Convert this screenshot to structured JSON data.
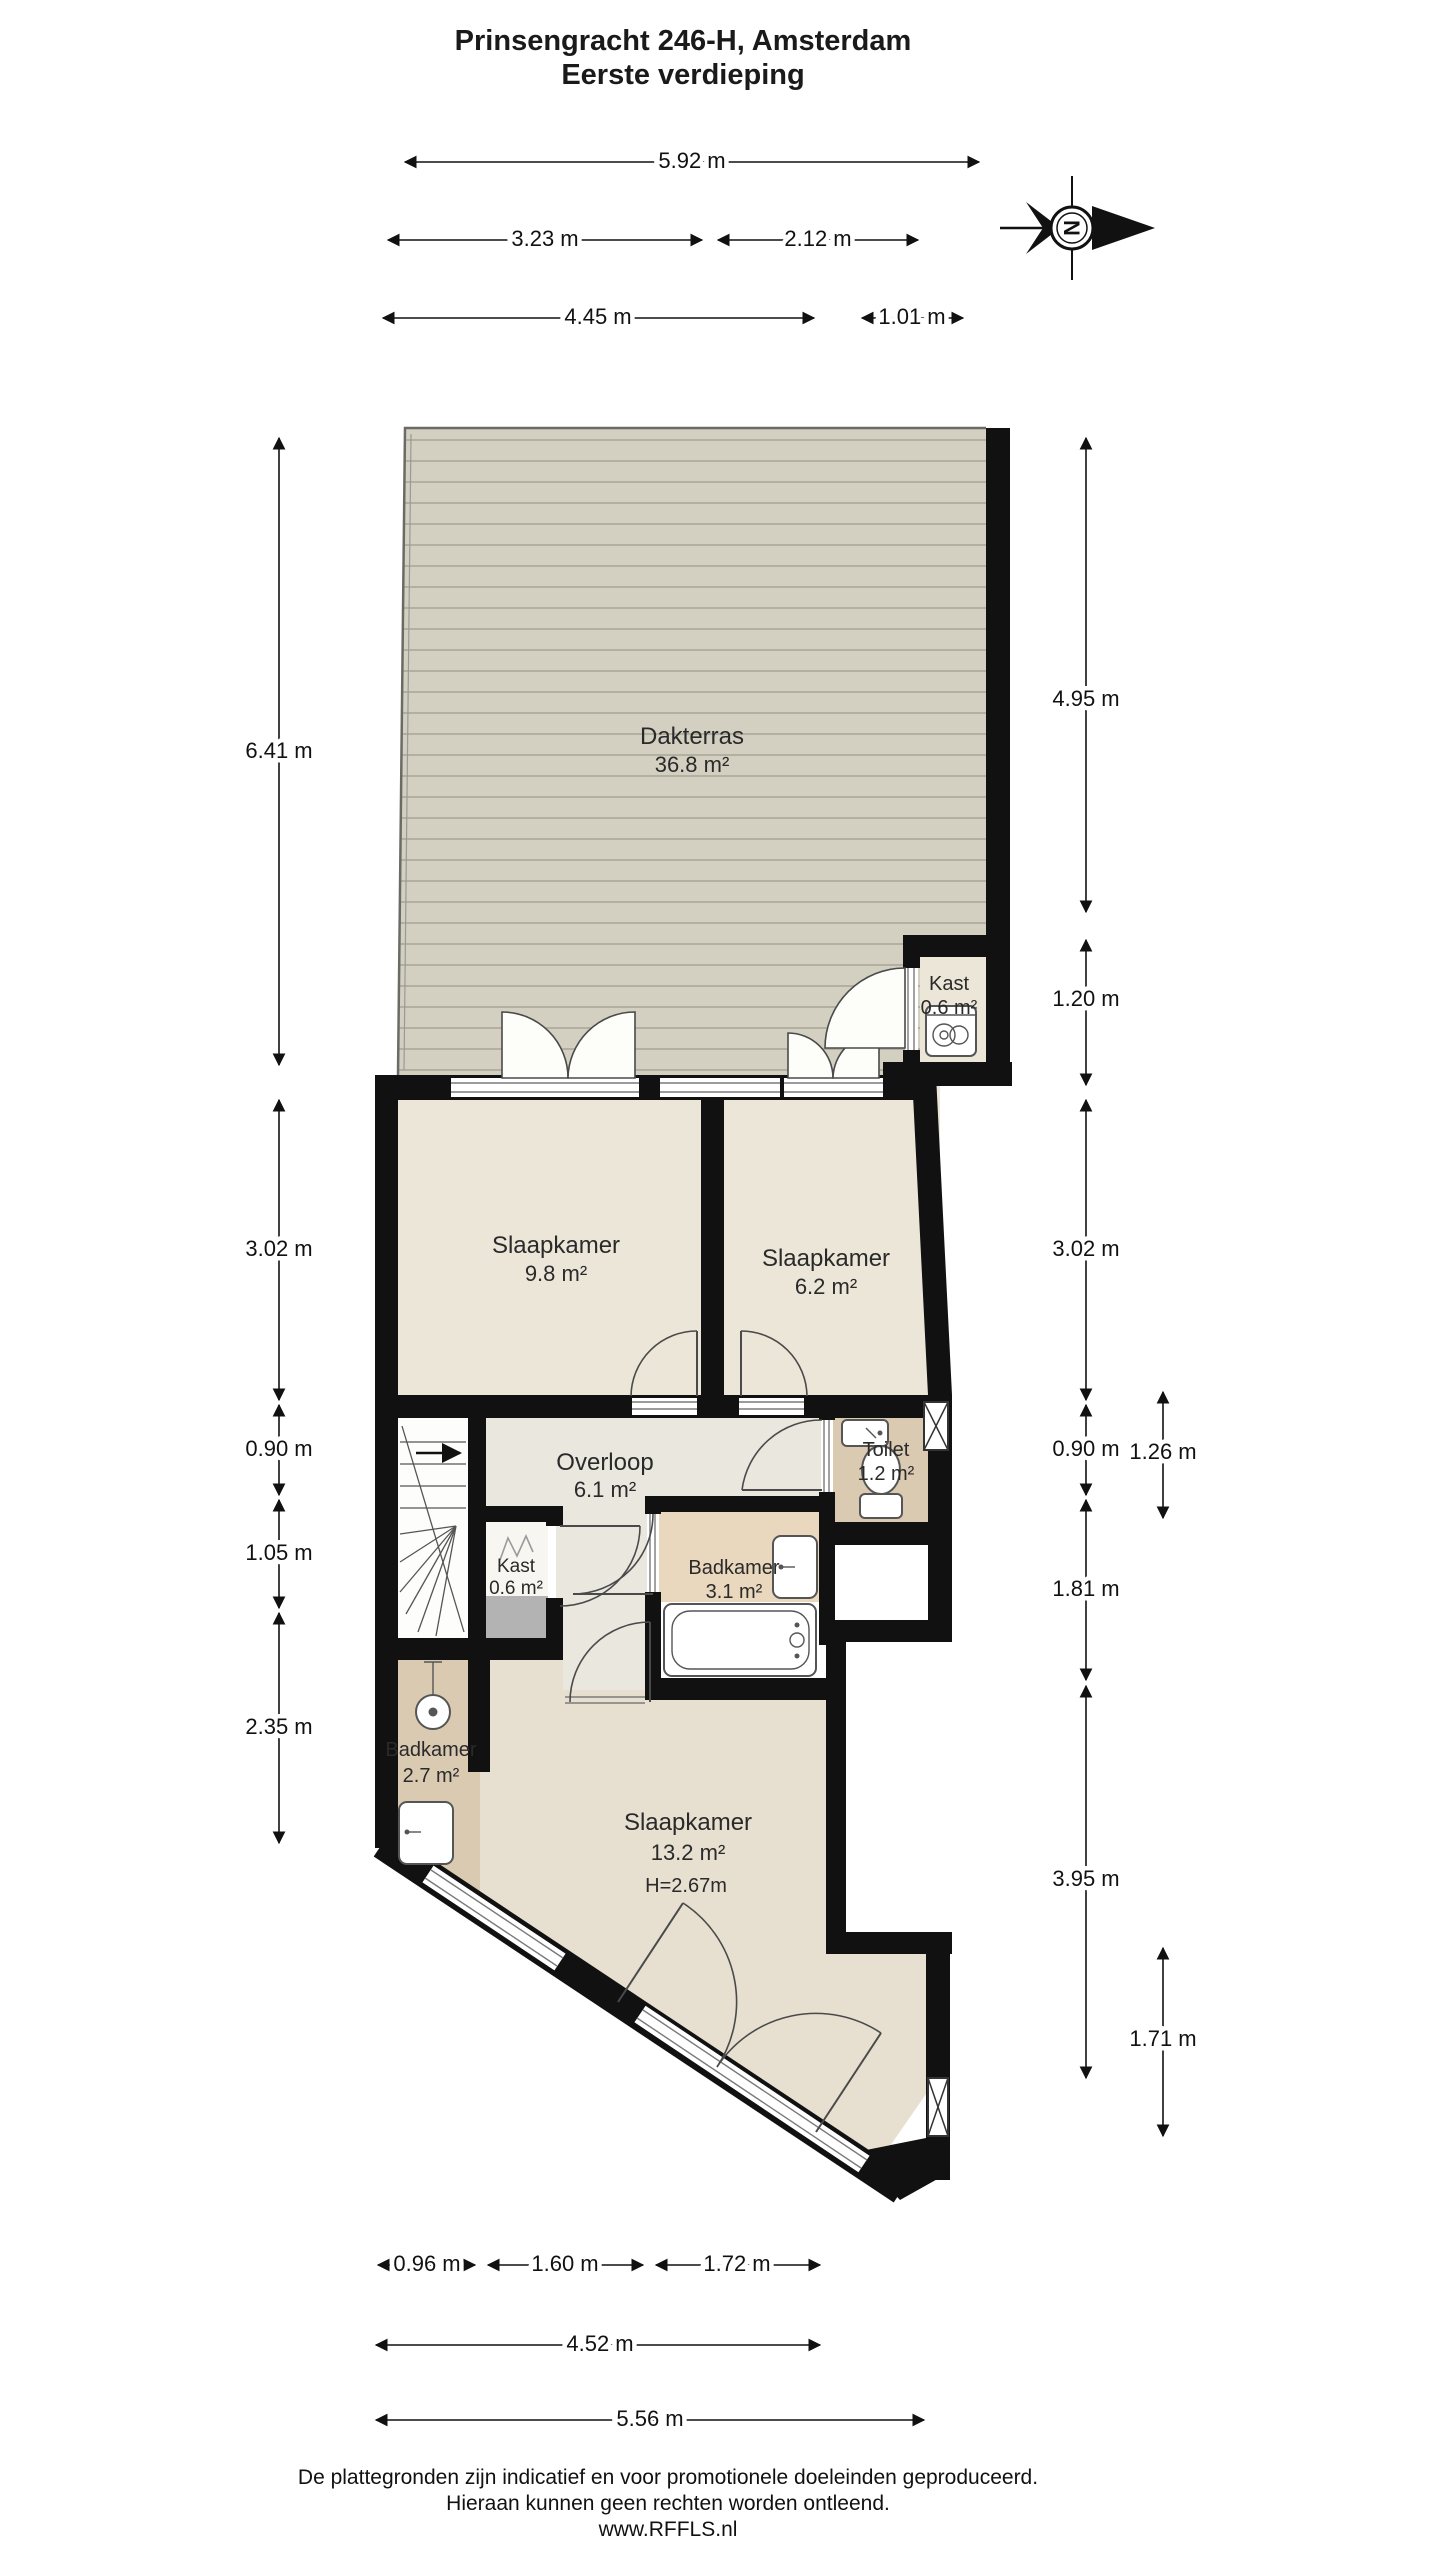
{
  "title": {
    "line1": "Prinsengracht 246-H, Amsterdam",
    "line2": "Eerste verdieping"
  },
  "compass": {
    "letter": "N"
  },
  "rooms": {
    "dakterras": {
      "name": "Dakterras",
      "area": "36.8 m²"
    },
    "kast_boven": {
      "name": "Kast",
      "area": "0.6 m²"
    },
    "slaapkamer_1": {
      "name": "Slaapkamer",
      "area": "9.8 m²"
    },
    "slaapkamer_2": {
      "name": "Slaapkamer",
      "area": "6.2 m²"
    },
    "overloop": {
      "name": "Overloop",
      "area": "6.1 m²"
    },
    "toilet": {
      "name": "Toilet",
      "area": "1.2 m²"
    },
    "kast_midden": {
      "name": "Kast",
      "area": "0.6 m²"
    },
    "badkamer_1": {
      "name": "Badkamer",
      "area": "3.1 m²"
    },
    "badkamer_2": {
      "name": "Badkamer",
      "area": "2.7 m²"
    },
    "slaapkamer_3": {
      "name": "Slaapkamer",
      "area": "13.2 m²",
      "height": "H=2.67m"
    }
  },
  "dimensions": {
    "top": [
      {
        "label": "5.92 m"
      },
      {
        "label": "3.23 m"
      },
      {
        "label": "2.12 m"
      },
      {
        "label": "4.45 m"
      },
      {
        "label": "1.01 m"
      }
    ],
    "left": [
      {
        "label": "6.41 m"
      },
      {
        "label": "3.02 m"
      },
      {
        "label": "0.90 m"
      },
      {
        "label": "1.05 m"
      },
      {
        "label": "2.35 m"
      }
    ],
    "right": [
      {
        "label": "4.95 m"
      },
      {
        "label": "1.20 m"
      },
      {
        "label": "3.02 m"
      },
      {
        "label": "0.90 m"
      },
      {
        "label": "1.26 m"
      },
      {
        "label": "1.81 m"
      },
      {
        "label": "3.95 m"
      },
      {
        "label": "1.71 m"
      }
    ],
    "bottom": [
      {
        "label": "0.96 m"
      },
      {
        "label": "1.60 m"
      },
      {
        "label": "1.72 m"
      },
      {
        "label": "4.52 m"
      },
      {
        "label": "5.56 m"
      }
    ]
  },
  "footer": {
    "line1": "De plattegronden zijn indicatief en voor promotionele doeleinden geproduceerd.",
    "line2": "Hieraan kunnen geen rechten worden ontleend.",
    "line3": "www.RFFLS.nl"
  },
  "colors": {
    "wall": "#111111",
    "room_cream": "#ebe6d8",
    "hall": "#e9e7de",
    "bath_tan": "#e9d8bd",
    "toilet_tan": "#dbcab2",
    "bedroom_beige": "#e7e0d1",
    "terrace": "#d3d0c1",
    "terrace_line": "#b3b0a1",
    "kast_gray": "#b3b3b3"
  }
}
